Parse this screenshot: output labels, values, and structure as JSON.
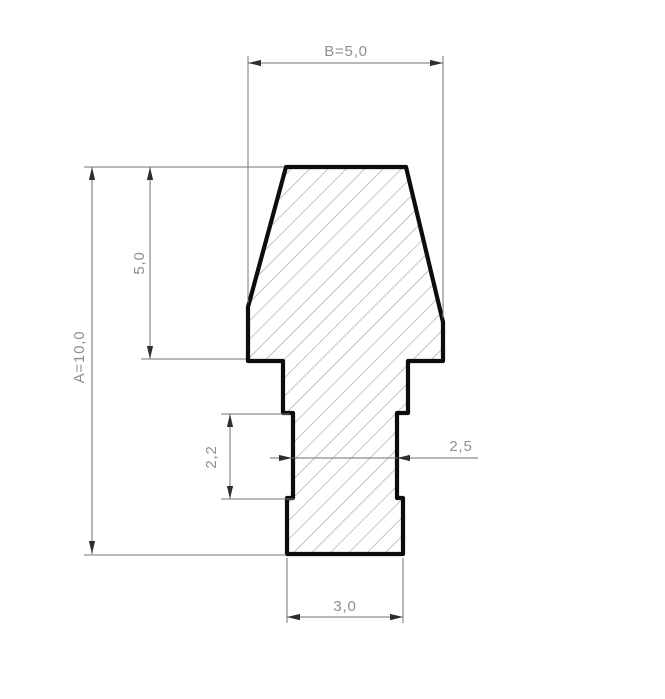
{
  "drawing": {
    "kind": "technical cross-section drawing with hatched profile and dimensions",
    "dims": {
      "top_width": "B=5,0",
      "overall_height": "A=10,0",
      "head_height": "5,0",
      "groove_height": "2,2",
      "waist_width": "2,5",
      "base_width": "3,0"
    },
    "values": {
      "B": 5.0,
      "A": 10.0,
      "head_height": 5.0,
      "groove_height": 2.2,
      "waist_width": 2.5,
      "base_width": 3.0
    },
    "colors": {
      "background": "#ffffff",
      "outline": "#0d0d0d",
      "hatch_lines": "#9f9f9f",
      "dimension_lines": "#6f6f6f",
      "dimension_text": "#8e8e8e"
    }
  }
}
